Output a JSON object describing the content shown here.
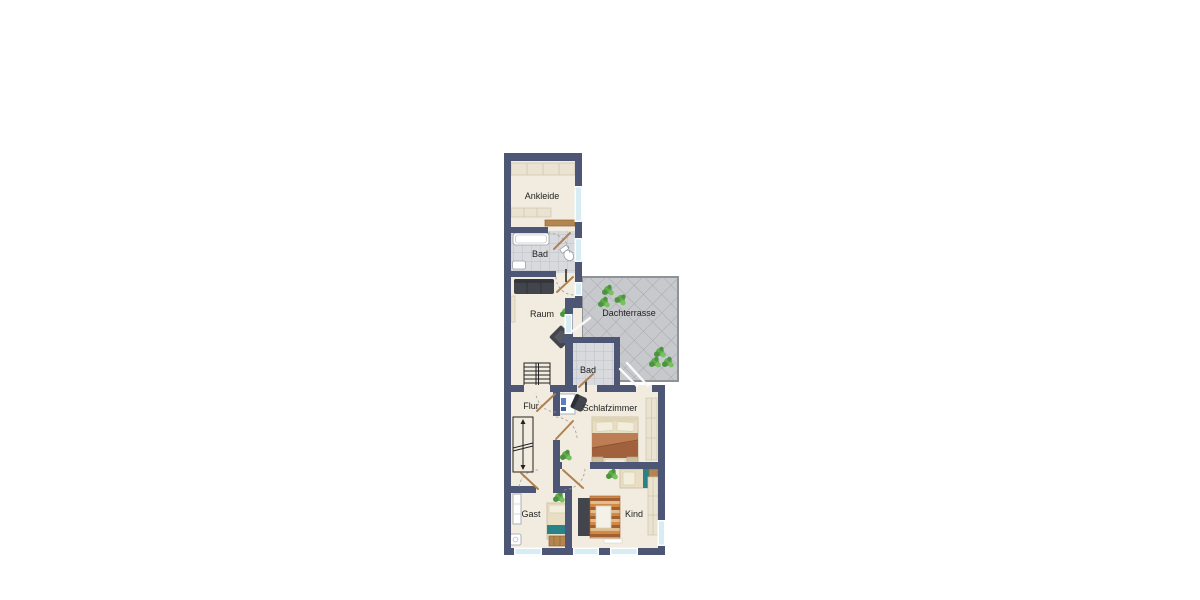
{
  "page": {
    "background": "#ffffff",
    "type": "apartment-floor-plan"
  },
  "colors": {
    "wall": "#4d5674",
    "floor": "#f1ecdf",
    "bath_tile": "#d8dade",
    "bath_tile_line": "#bcc0c6",
    "terrace_tile": "#c7c9cc",
    "terrace_tile_line": "#a6a9ae",
    "terrace_border": "#8f9296",
    "window_glass": "#d8ecf4",
    "window_frame": "#fbfdfe",
    "furniture_dark": "#42454c",
    "wood": "#b5854f",
    "plant": "#5aa648",
    "teal": "#2a8289",
    "bed_base": "#e8dec4",
    "blanket": "#a0613c",
    "label_text": "#1f1f1f"
  },
  "rooms": [
    {
      "id": "ankleide",
      "label": "Ankleide"
    },
    {
      "id": "bad-upper",
      "label": "Bad"
    },
    {
      "id": "raum",
      "label": "Raum"
    },
    {
      "id": "dachterrasse",
      "label": "Dachterrasse"
    },
    {
      "id": "bad-small",
      "label": "Bad"
    },
    {
      "id": "flur",
      "label": "Flur"
    },
    {
      "id": "schlafzimmer",
      "label": "Schlafzimmer"
    },
    {
      "id": "gast",
      "label": "Gast"
    },
    {
      "id": "kind",
      "label": "Kind"
    }
  ]
}
